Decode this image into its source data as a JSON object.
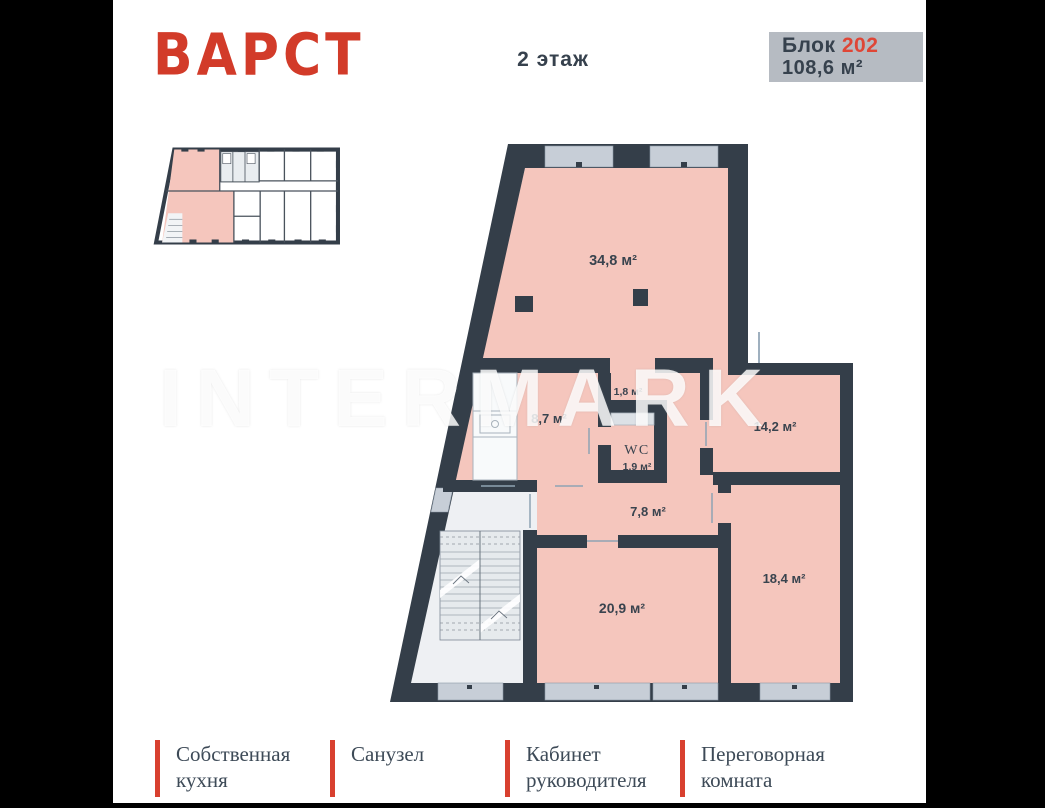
{
  "brand": {
    "logo_text": "ВАРСТ",
    "logo_color": "#d23b29"
  },
  "header": {
    "floor_label": "2 этаж"
  },
  "badge": {
    "block_label": "Блок",
    "block_number": "202",
    "block_area": "108,6 м²",
    "bg_color": "#b6bbc2",
    "number_color": "#df4636"
  },
  "watermark": {
    "text": "INTERMARK"
  },
  "plan": {
    "rooms": [
      {
        "id": "open-space",
        "area": "34,8 м²"
      },
      {
        "id": "hall",
        "area": "1,8 м²"
      },
      {
        "id": "kitchen",
        "area": "8,7 м²"
      },
      {
        "id": "wc",
        "label": "WC",
        "area": "1,9 м²"
      },
      {
        "id": "meeting-room",
        "area": "14,2 м²"
      },
      {
        "id": "corridor",
        "area": "7,8 м²"
      },
      {
        "id": "office-1",
        "area": "20,9 м²"
      },
      {
        "id": "office-2",
        "area": "18,4 м²"
      }
    ],
    "colors": {
      "wall": "#343e49",
      "room_fill": "#f5c6bd",
      "window": "#c7ced7",
      "stair_area": "#eef0f3"
    }
  },
  "legend": {
    "accent": "#d8402f",
    "items": [
      {
        "label": "Собственная кухня"
      },
      {
        "label": "Санузел"
      },
      {
        "label": "Кабинет руководителя"
      },
      {
        "label": "Переговорная комната"
      }
    ]
  }
}
